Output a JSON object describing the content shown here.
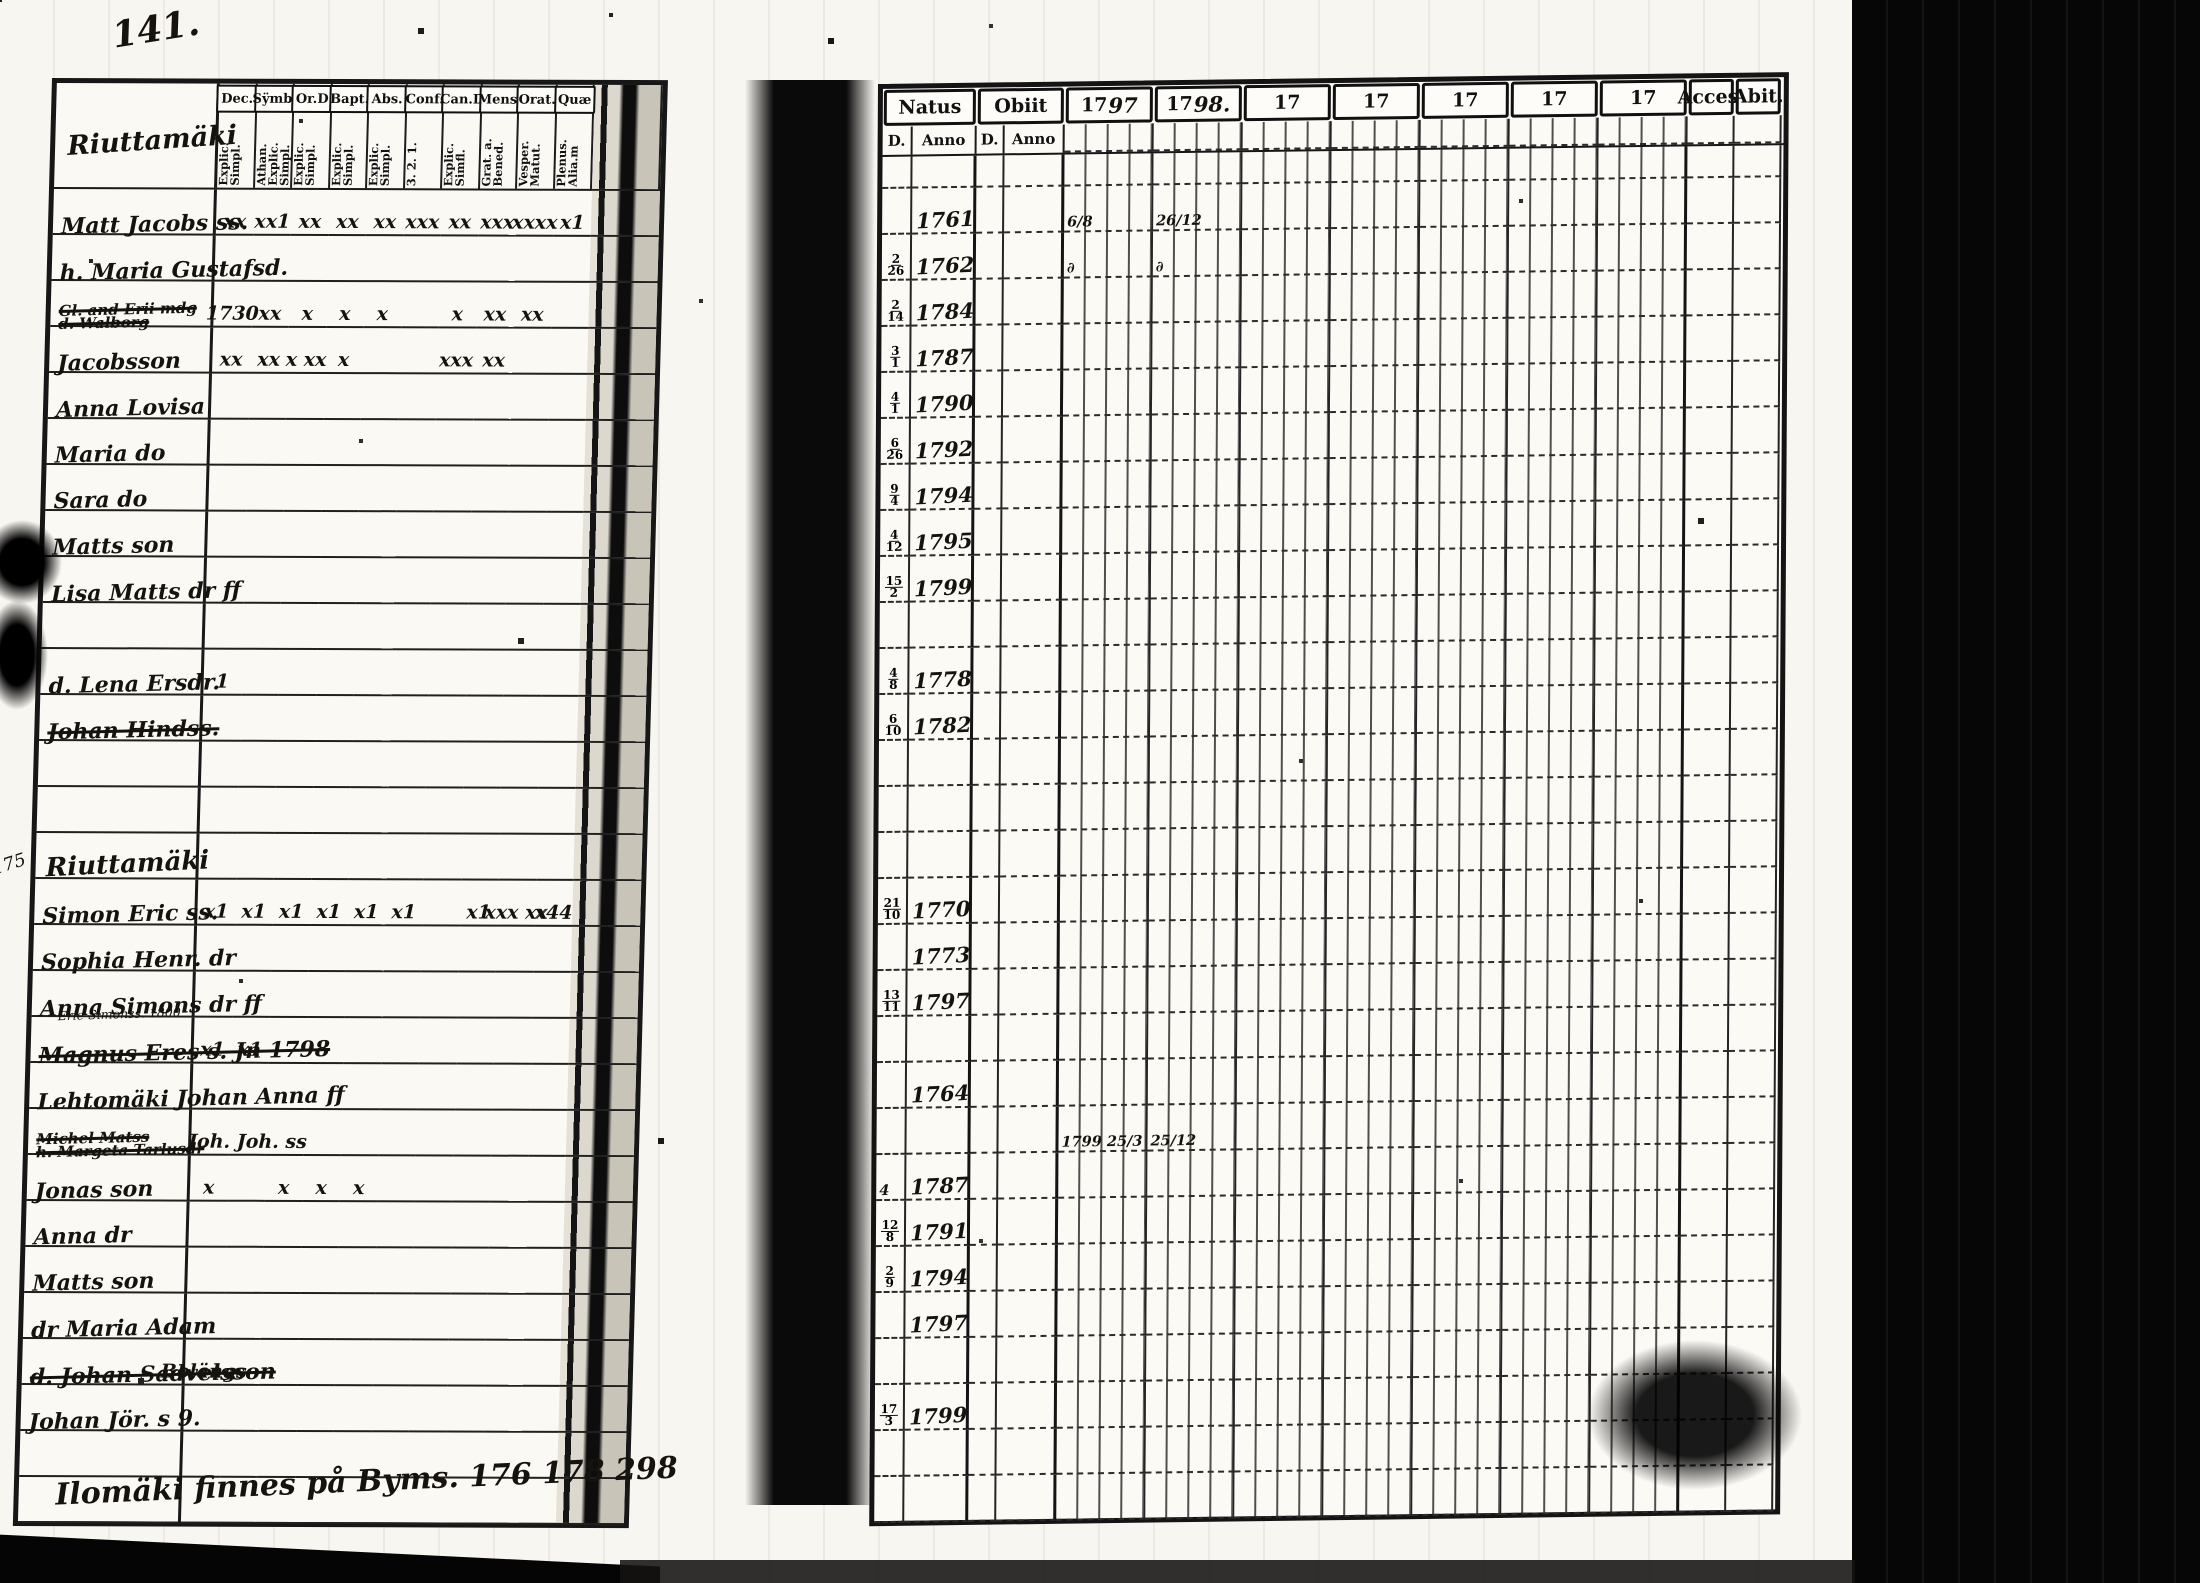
{
  "page": {
    "number": "141.",
    "bottom_note": "Ilomäki finnes på Byms. 176 178 298",
    "margin_note": "175"
  },
  "left_table": {
    "section_title": "Riuttamäki",
    "columns": [
      {
        "label": "Dec.",
        "sub": "Explic. Simpl."
      },
      {
        "label": "Sÿmb.",
        "sub": "Athan. Explic. Simpl."
      },
      {
        "label": "Or.D",
        "sub": "Explic. Simpl."
      },
      {
        "label": "Bapt.",
        "sub": "Explic. Simpl."
      },
      {
        "label": "Abs.",
        "sub": "Explic. Simpl."
      },
      {
        "label": "Conf.",
        "sub": "3. 2. 1."
      },
      {
        "label": "Can.D",
        "sub": "Explic. Simfl."
      },
      {
        "label": "Mens.",
        "sub": "Grat. a. Bened."
      },
      {
        "label": "Orat.",
        "sub": "Vesper. Matut."
      },
      {
        "label": "Quæ",
        "sub": "Plenus. Alia.m"
      }
    ]
  },
  "right_table": {
    "groups": [
      {
        "label": "Natus",
        "subs": [
          "D.",
          "Anno"
        ]
      },
      {
        "label": "Obiit",
        "subs": [
          "D.",
          "Anno"
        ]
      }
    ],
    "years": [
      "1797",
      "1798.",
      "17",
      "17",
      "17",
      "17",
      "17"
    ],
    "end_columns": [
      "Acces.",
      "Abit."
    ]
  },
  "rows": [
    {
      "type": "name",
      "name": "Matt Jacobs ss.",
      "marks": [
        "xx",
        "xx1",
        "xx",
        "xx",
        "xx",
        "xxx",
        "xx",
        "xxx",
        "xxxx",
        "x1"
      ],
      "natus_anno": "1761",
      "y1797": "6/8",
      "y1798": "26/12"
    },
    {
      "type": "name",
      "name": "h. Maria Gustafsd.",
      "marks": [],
      "natus_d": "2/26",
      "natus_anno": "1762",
      "y1797": "∂",
      "y1798": "∂"
    },
    {
      "type": "name",
      "name": "Gl. and Erii mdg",
      "name2": "d. Walborg",
      "struck": true,
      "marks": [
        "1730",
        "xx",
        "x",
        "x",
        "x",
        "",
        "x",
        "xx",
        "xx",
        ""
      ],
      "natus_d": "2/14",
      "natus_anno": "1784"
    },
    {
      "type": "name",
      "name": "Jacobsson",
      "marks": [
        "xx",
        "xx",
        "x xx",
        "x",
        "",
        "",
        "xxx",
        "xx",
        "",
        ""
      ],
      "natus_d": "3/1",
      "natus_anno": "1787"
    },
    {
      "type": "name",
      "name": "Anna Lovisa",
      "marks": [],
      "natus_d": "4/1",
      "natus_anno": "1790"
    },
    {
      "type": "name",
      "name": "Maria do",
      "marks": [],
      "natus_d": "6/26",
      "natus_anno": "1792"
    },
    {
      "type": "name",
      "name": "Sara do",
      "marks": [],
      "natus_d": "9/4",
      "natus_anno": "1794"
    },
    {
      "type": "name",
      "name": "Matts son",
      "marks": [],
      "natus_d": "4/12",
      "natus_anno": "1795"
    },
    {
      "type": "name",
      "name": "Lisa Matts dr ff",
      "marks": [],
      "natus_d": "15/2",
      "natus_anno": "1799"
    },
    {
      "type": "blank"
    },
    {
      "type": "name",
      "name": "d. Lena Ersdr.",
      "marks": [
        "1",
        "",
        "",
        "",
        "",
        "",
        "",
        "",
        "",
        ""
      ],
      "natus_d": "4/8",
      "natus_anno": "1778"
    },
    {
      "type": "name",
      "name": "Johan Hindss.",
      "struck": true,
      "marks": [],
      "natus_d": "6/10",
      "natus_anno": "1782"
    },
    {
      "type": "blank"
    },
    {
      "type": "blank"
    },
    {
      "type": "section",
      "name": "Riuttamäki",
      "margin": "175"
    },
    {
      "type": "name",
      "name": "Simon Eric ss.",
      "marks": [
        "x1",
        "x1",
        "x1",
        "x1",
        "x1",
        "x1",
        "",
        "x1",
        "xxx xx",
        "x44"
      ],
      "natus_d": "21/10",
      "natus_anno": "1770"
    },
    {
      "type": "name",
      "name": "Sophia Henr. dr",
      "marks": [],
      "natus_anno": "1773"
    },
    {
      "type": "name",
      "name": "Anna Simons dr ff",
      "marks": [],
      "natus_d": "13/11",
      "natus_anno": "1797"
    },
    {
      "type": "name",
      "name": "Magnus Eres s. Jn 1798",
      "struck": true,
      "note": "Erie Simonss. 1800",
      "marks": [
        "x1",
        "x1",
        "",
        "",
        "",
        "",
        "",
        "",
        "",
        ""
      ]
    },
    {
      "type": "name",
      "name": "Lehtomäki Johan Anna ff",
      "marks": [],
      "natus_anno": "1764"
    },
    {
      "type": "name",
      "name": "Michel Matss",
      "name2": "h. Margeta Tarlusdr",
      "struck": true,
      "marks": [
        "",
        "Joh. Joh. ss",
        "",
        "",
        "",
        "",
        "",
        "",
        "",
        ""
      ],
      "y1797": "1799 25/3",
      "y1798": "25/12"
    },
    {
      "type": "name",
      "name": "Jonas son",
      "marks": [
        "x",
        "",
        "x",
        "x",
        "x",
        "",
        "",
        "",
        "",
        ""
      ],
      "natus_d": "4",
      "natus_anno": "1787"
    },
    {
      "type": "name",
      "name": "Anna dr",
      "marks": [],
      "natus_d": "12/8",
      "natus_anno": "1791"
    },
    {
      "type": "name",
      "name": "Matts son",
      "marks": [],
      "natus_d": "2/9",
      "natus_anno": "1794"
    },
    {
      "type": "name",
      "name": "dr Maria Adam",
      "marks": [],
      "natus_anno": "1797"
    },
    {
      "type": "name",
      "name": "d. Johan Sadvelsson",
      "struck": true,
      "marks": [
        "Bolängs",
        "",
        "",
        "",
        "",
        "",
        "",
        "",
        "",
        ""
      ]
    },
    {
      "type": "name",
      "name": "Johan Jör. s 9.",
      "marks": [],
      "natus_d": "17/3",
      "natus_anno": "1799"
    },
    {
      "type": "blank"
    },
    {
      "type": "blank"
    }
  ]
}
